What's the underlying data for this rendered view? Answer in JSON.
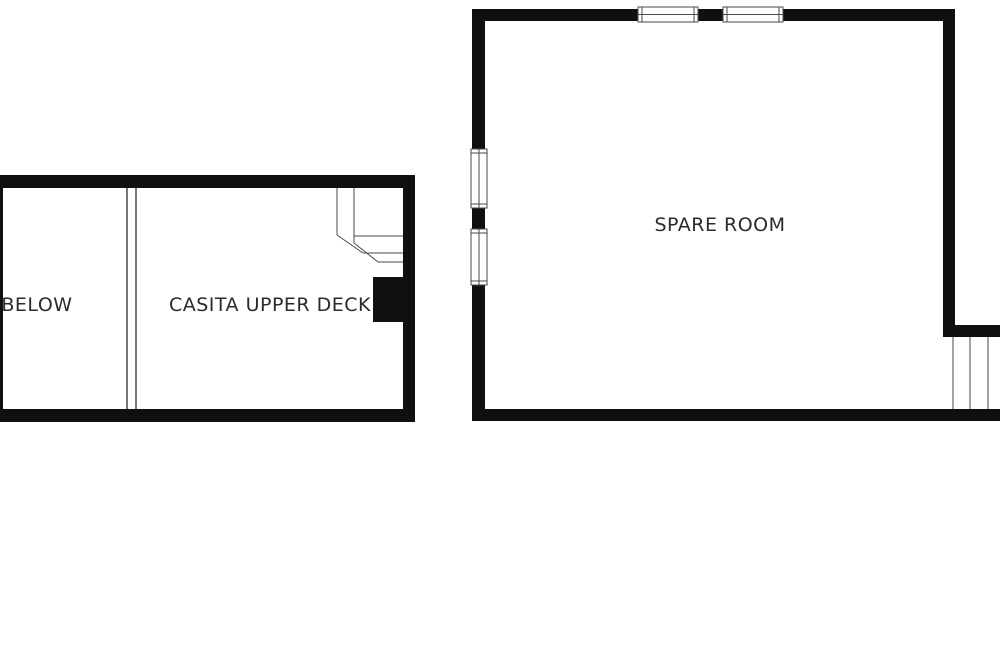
{
  "canvas": {
    "width": 1000,
    "height": 666
  },
  "colors": {
    "background": "#ffffff",
    "wall": "#101010",
    "thin_line": "#4a4a4a",
    "label_text": "#2b2b2b",
    "window_fill": "#ffffff"
  },
  "floor_plan": {
    "type": "floor-plan",
    "labels": {
      "below": "BELOW",
      "casita_upper_deck": "CASITA UPPER DECK",
      "spare_room": "SPARE ROOM"
    }
  }
}
